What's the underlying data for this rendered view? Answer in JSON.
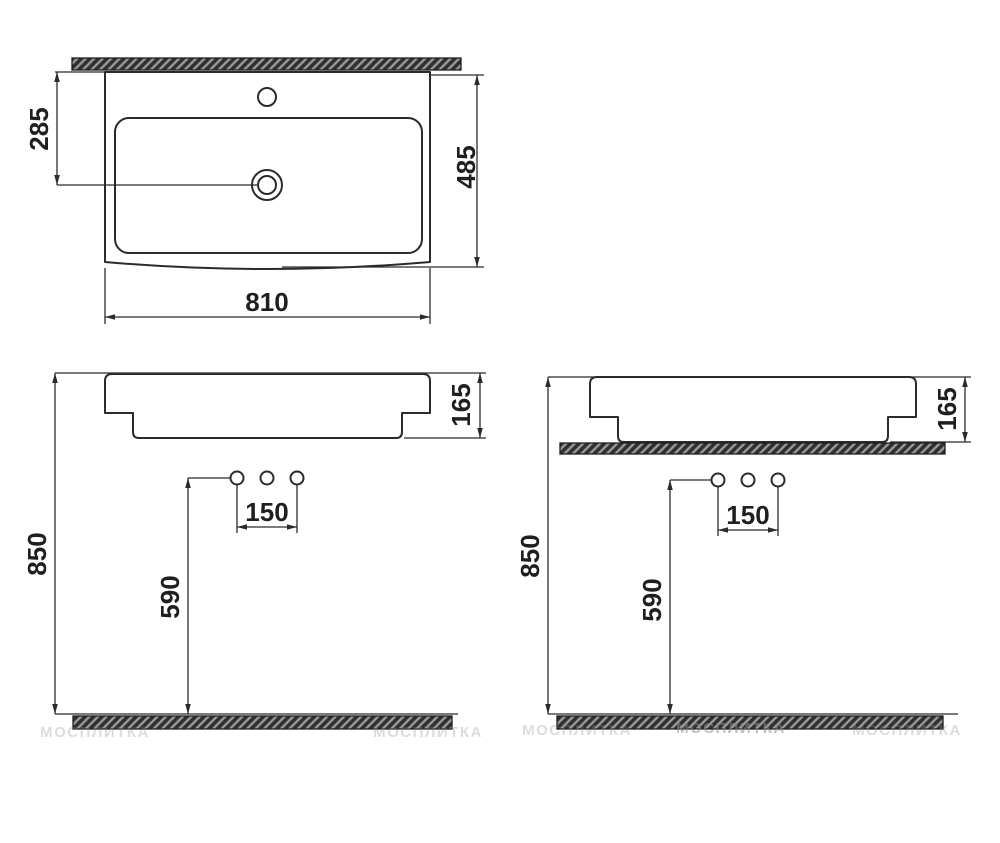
{
  "drawing_title": "Washbasin installation dimensions",
  "plan": {
    "depth_to_drain": "285",
    "total_depth": "485",
    "total_width": "810"
  },
  "front_wall": {
    "height": "165",
    "rim_height": "850",
    "drain_height": "590",
    "hole_spacing": "150"
  },
  "front_counter": {
    "height": "165",
    "rim_height": "850",
    "drain_height": "590",
    "hole_spacing": "150"
  },
  "watermark": "МОСПЛИТКА",
  "colors": {
    "line": "#2b2b2b",
    "hatch_dark": "#2f2f2f",
    "hatch_light": "#9a9a9a",
    "background": "#ffffff"
  }
}
